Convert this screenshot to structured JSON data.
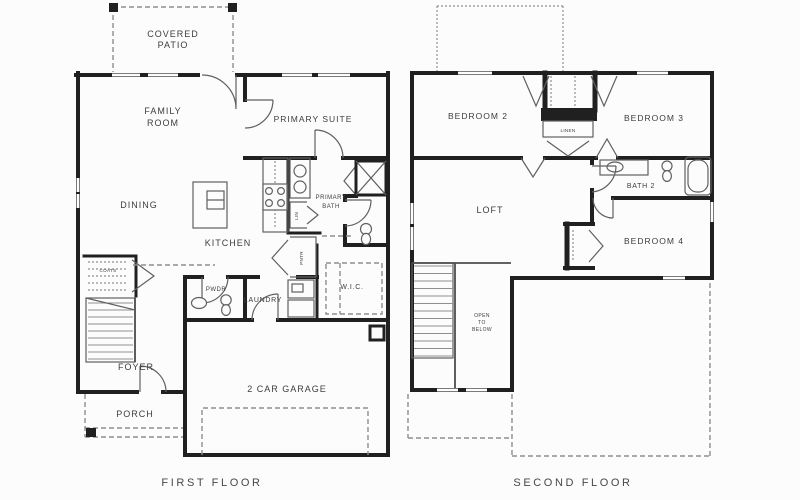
{
  "colors": {
    "background": "#fcfcfc",
    "wall": "#202020",
    "line": "#606060",
    "dash": "#8e8e8e",
    "text": "#3d3d3d"
  },
  "first": {
    "title": "FIRST FLOOR",
    "labels": {
      "covered_patio_1": "COVERED",
      "covered_patio_2": "PATIO",
      "family_1": "FAMILY",
      "family_2": "ROOM",
      "primary_suite": "PRIMARY SUITE",
      "dining": "DINING",
      "kitchen": "KITCHEN",
      "primary_bath_1": "PRIMARY",
      "primary_bath_2": "BATH",
      "lin": "LIN",
      "pntr": "PNTR",
      "wic": "W.I.C.",
      "pwdr": "PWDR",
      "laundry": "LAUNDRY",
      "coats": "COATS",
      "foyer": "FOYER",
      "porch": "PORCH",
      "garage": "2 CAR GARAGE"
    }
  },
  "second": {
    "title": "SECOND FLOOR",
    "labels": {
      "bedroom2": "BEDROOM 2",
      "bedroom3": "BEDROOM 3",
      "linen": "LINEN",
      "loft": "LOFT",
      "bath2": "BATH 2",
      "bedroom4": "BEDROOM 4",
      "open_1": "OPEN",
      "open_2": "TO",
      "open_3": "BELOW"
    }
  }
}
